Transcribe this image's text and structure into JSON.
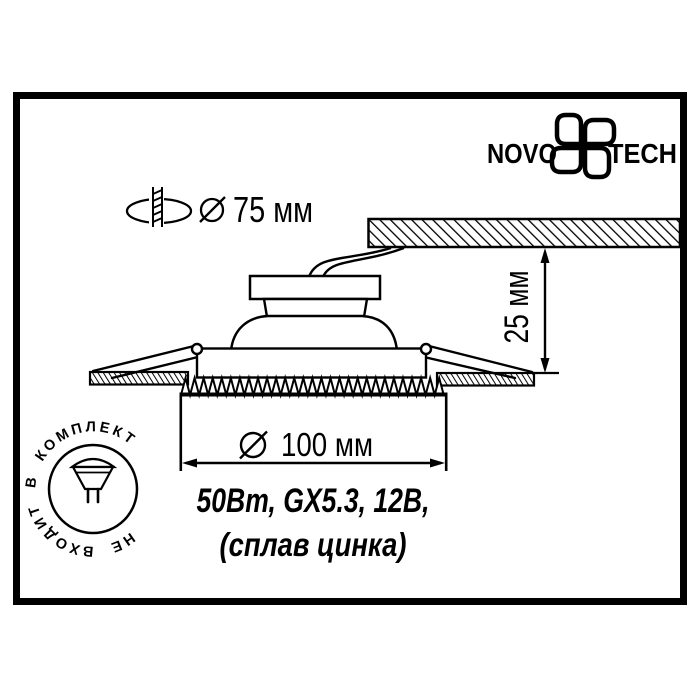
{
  "brand": {
    "name_left": "NOVO",
    "name_right": "TECH"
  },
  "labels": {
    "cutout_diameter": "75 мм",
    "recess_depth": "25 мм",
    "trim_diameter": "100 мм",
    "spec_line1": "50Вт, GX5.3, 12В,",
    "spec_line2": "(сплав цинка)",
    "stamp": "НЕ ВХОДИТ В КОМПЛЕКТ"
  },
  "icons": {
    "logo_pinwheel": "four-petal pinwheel outline",
    "drill_hole": "drill bit through ceiling hole ellipse",
    "diameter_symbol": "circle with diagonal slash",
    "lamp_bulb": "MR16 halogen lamp with two pins"
  },
  "colors": {
    "ink": "#000000",
    "paper": "#ffffff"
  }
}
